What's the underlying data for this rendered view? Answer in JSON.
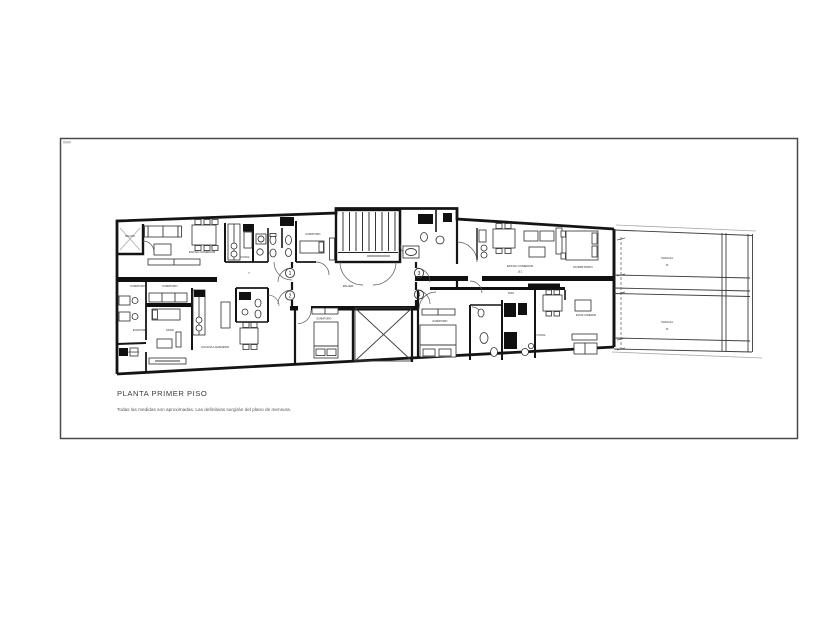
{
  "sheet": {
    "background": "#ffffff",
    "frame_color": "#4a4a4a",
    "ink_color": "#141414"
  },
  "title_block": {
    "title": "PLANTA PRIMER PISO",
    "note": "Todas las medidas son aproximadas. Las definitivas surgirán del plano de mensura."
  },
  "plan": {
    "unit_badges": [
      "1",
      "2",
      "3",
      "4"
    ],
    "labels": [
      {
        "text": "BALCON"
      },
      {
        "text": "ESTAR COMEDOR"
      },
      {
        "text": "COCINA"
      },
      {
        "text": "DORMITORIO"
      },
      {
        "text": "DORMITORIO"
      },
      {
        "text": "DORMITORIO"
      },
      {
        "text": "ESCRITORIO"
      },
      {
        "text": "ESTAR"
      },
      {
        "text": "LAVADERO"
      },
      {
        "text": "COCINA LAVADERO"
      },
      {
        "text": "PALIER"
      },
      {
        "text": "PASO"
      },
      {
        "text": "ESTAR COMEDOR"
      },
      {
        "text": "16.2"
      },
      {
        "text": "DORMITORIO"
      },
      {
        "text": "DORMITORIO"
      },
      {
        "text": "COCINA"
      },
      {
        "text": "ESTAR COMEDOR"
      },
      {
        "text": "TERRAZA"
      },
      {
        "text": "30"
      },
      {
        "text": "TERRAZA"
      },
      {
        "text": "30"
      },
      {
        "text": "DORMITORIO"
      },
      {
        "text": "7"
      }
    ]
  }
}
